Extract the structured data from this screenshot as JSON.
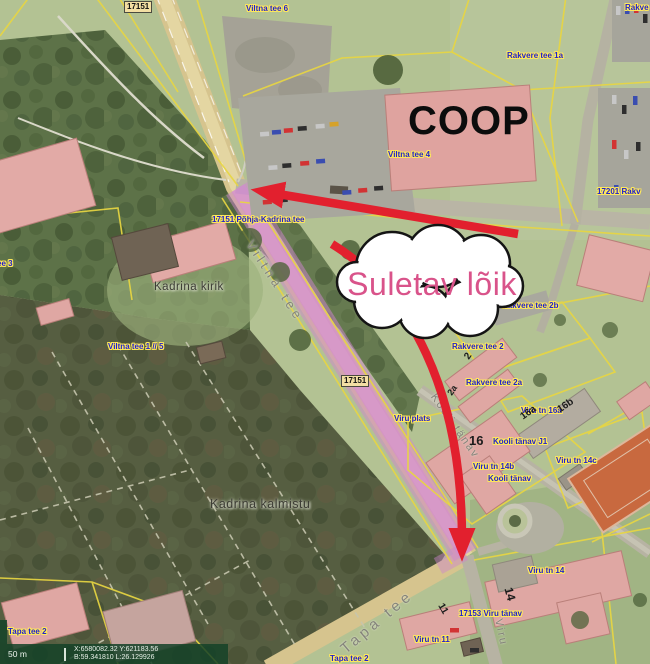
{
  "map": {
    "road_number_boxes": [
      "17151",
      "17151"
    ],
    "address_labels": [
      "Viltna tee 6",
      "Rakve",
      "Rakvere tee 1a",
      "Viltna tee 4",
      "17151 Põhja-Kadrina tee",
      "17201 Rakv",
      "Rakvere tee 2b",
      "Rakvere tee 2",
      "Rakvere tee 2a",
      "Viru tn 16a",
      "Viru plats",
      "Kooli tänav J1",
      "Viru tn 14b",
      "Kooli tänav",
      "Viru tn 14c",
      "Viru tn 14",
      "17153 Viru tänav",
      "Viru tn 11",
      "Viltna tee 1 // 5",
      "Tapa tee 2",
      "Tapa tee 2",
      "ee 3"
    ],
    "place_labels": {
      "church": "Kadrina kirik",
      "cemetery": "Kadrina kalmistu",
      "store": "COOP"
    },
    "road_name_labels": {
      "viltna": "Viltna tee",
      "tapa": "Tapa tee",
      "viru": "Viru",
      "kooli": "Kooli tänav"
    },
    "building_numbers": [
      "16",
      "16a",
      "16b",
      "14",
      "11",
      "2",
      "2a"
    ]
  },
  "annotation": {
    "callout_text": "Suletav lõik",
    "arrow_color": "#e2202e",
    "callout_text_color": "#d9538a",
    "highlight_color": "#cf86cf"
  },
  "statusbar": {
    "scale_label": "50 m",
    "coordinates_xy": "X:6580082.32 Y:621183.56",
    "coordinates_bl": "B:59.341810 L:26.129926"
  }
}
